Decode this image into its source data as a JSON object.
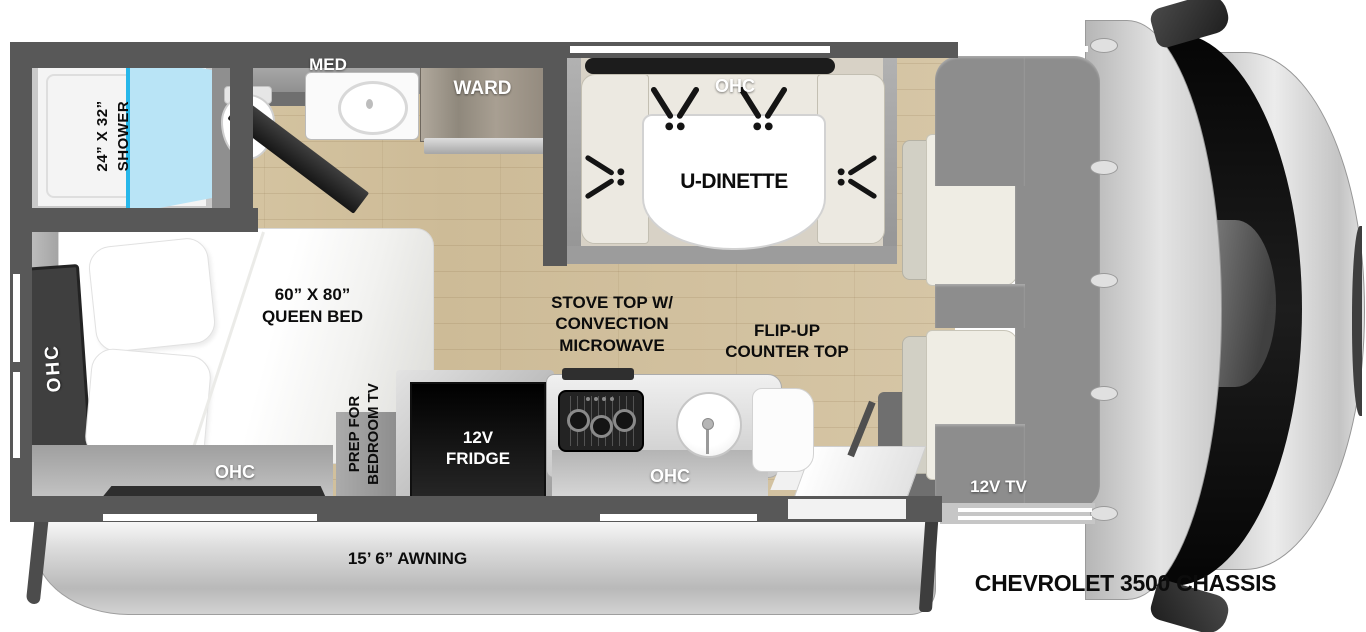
{
  "floorplan": {
    "chassis_label": "CHEVROLET 3500 CHASSIS",
    "awning_label": "15’ 6” AWNING",
    "bathroom": {
      "shower_size": "24” X 32”",
      "shower_name": "SHOWER",
      "med": "MED"
    },
    "wardrobe_label": "WARD",
    "dinette": {
      "ohc": "OHC",
      "table_label": "U-DINETTE"
    },
    "cab": {
      "bunk_label": "60 X 80 BUNK",
      "tv_label": "12V TV"
    },
    "bedroom": {
      "bed_size": "60” X 80”",
      "bed_name": "QUEEN BED",
      "ohc_side": "OHC",
      "ohc_rear": "OHC",
      "tv_prep_line1": "PREP FOR",
      "tv_prep_line2": "BEDROOM TV"
    },
    "kitchen": {
      "fridge_line1": "12V",
      "fridge_line2": "FRIDGE",
      "stove_line1": "STOVE TOP W/",
      "stove_line2": "CONVECTION",
      "stove_line3": "MICROWAVE",
      "flip_line1": "FLIP-UP",
      "flip_line2": "COUNTER TOP",
      "ohc": "OHC"
    }
  },
  "colors": {
    "wall": "#585858",
    "floor_wood": "#d2c1a0",
    "glass_accent": "#27b7ea",
    "bunk_gray": "#8d8d8d",
    "seat_cream": "#efede4"
  }
}
